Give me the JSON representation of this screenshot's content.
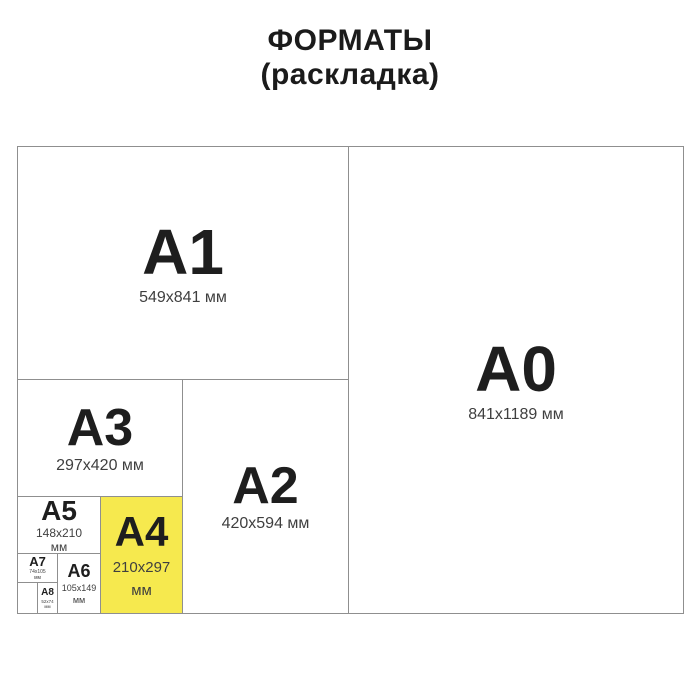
{
  "title": {
    "line1": "ФОРМАТЫ",
    "line2": "(раскладка)"
  },
  "formats": {
    "a0": {
      "label": "A0",
      "size": "841x1189 мм"
    },
    "a1": {
      "label": "A1",
      "size": "549x841 мм"
    },
    "a2": {
      "label": "A2",
      "size": "420x594 мм"
    },
    "a3": {
      "label": "A3",
      "size": "297x420 мм"
    },
    "a4": {
      "label": "A4",
      "size_line1": "210x297",
      "size_line2": "мм",
      "highlighted": true
    },
    "a5": {
      "label": "A5",
      "size_line1": "148x210",
      "size_line2": "мм"
    },
    "a6": {
      "label": "A6",
      "size_line1": "105x149",
      "size_line2": "мм"
    },
    "a7": {
      "label": "A7",
      "size_line1": "74x105",
      "size_line2": "мм"
    },
    "a8": {
      "label": "A8",
      "size_line1": "52x74",
      "size_line2": "мм"
    }
  },
  "colors": {
    "highlight": "#F6E94E",
    "border": "#8F8F8F",
    "label_text": "#1E1E1E",
    "size_text": "#3F3F3F",
    "background": "#FFFFFF"
  }
}
